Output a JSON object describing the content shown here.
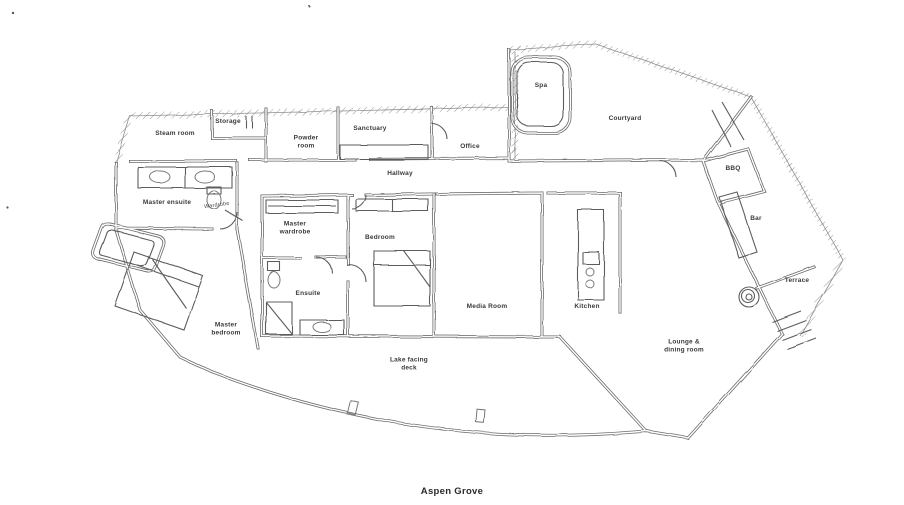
{
  "title": "Aspen Grove",
  "colors": {
    "background": "#ffffff",
    "ink": "#6a6a6a",
    "label_text": "#3a3a3a"
  },
  "plan": {
    "rooms": {
      "steam_room": "Steam room",
      "storage": "Storage",
      "powder_room": "Powder\nroom",
      "sanctuary": "Sanctuary",
      "office": "Office",
      "hallway": "Hallway",
      "spa": "Spa",
      "courtyard": "Courtyard",
      "bbq": "BBQ",
      "bar": "Bar",
      "terrace": "Terrace",
      "master_ensuite": "Master ensuite",
      "wardrobe": "Wardrobe",
      "master_wardrobe": "Master\nwardrobe",
      "bedroom": "Bedroom",
      "ensuite": "Ensuite",
      "media_room": "Media Room",
      "kitchen": "Kitchen",
      "lounge_dining": "Lounge &\ndining room",
      "lake_deck": "Lake facing\ndeck",
      "master_bedroom": "Master\nbedroom"
    }
  }
}
